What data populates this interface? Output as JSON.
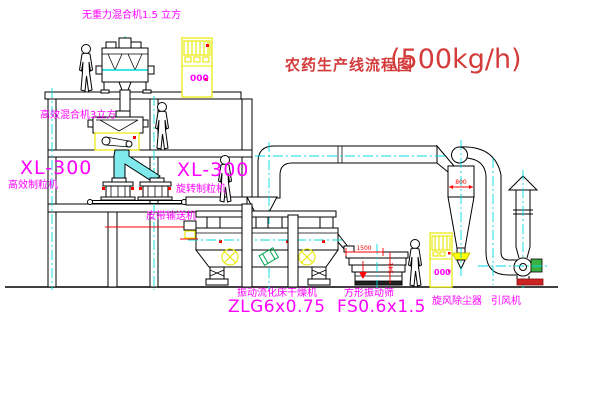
{
  "title": {
    "text_cn": "农药生产线流程图",
    "capacity": "(500kg/h)"
  },
  "equipment": {
    "top_mixer": {
      "label": "无重力混合机1.5 立方"
    },
    "mid_mixer": {
      "label": "高效混合机3立方"
    },
    "granulator_left": {
      "model": "XL-300",
      "name": "高效制粒机"
    },
    "granulator_right": {
      "model": "XL-300",
      "name": "旋转制粒机"
    },
    "belt_conveyor": {
      "name": "皮带输送机"
    },
    "dryer": {
      "name": "振动流化床干燥机",
      "model": "ZLG6x0.75"
    },
    "sieve": {
      "name": "方形振动筛",
      "model": "FS0.6x1.5",
      "dim_width": "1500",
      "dim_height": "541"
    },
    "cyclone": {
      "name": "旋风除尘器",
      "dim_diameter": "800"
    },
    "fan": {
      "name": "引风机"
    },
    "control_cabinet": {
      "display": "000"
    }
  },
  "colors": {
    "label_magenta": "#ff00ff",
    "title_red": "#d43b3b",
    "dimension_red": "#ff0000",
    "cad_yellow": "#ffff00",
    "cad_cyan": "#00dcdc",
    "motor_green": "#2faa4a",
    "line_black": "#000000"
  }
}
